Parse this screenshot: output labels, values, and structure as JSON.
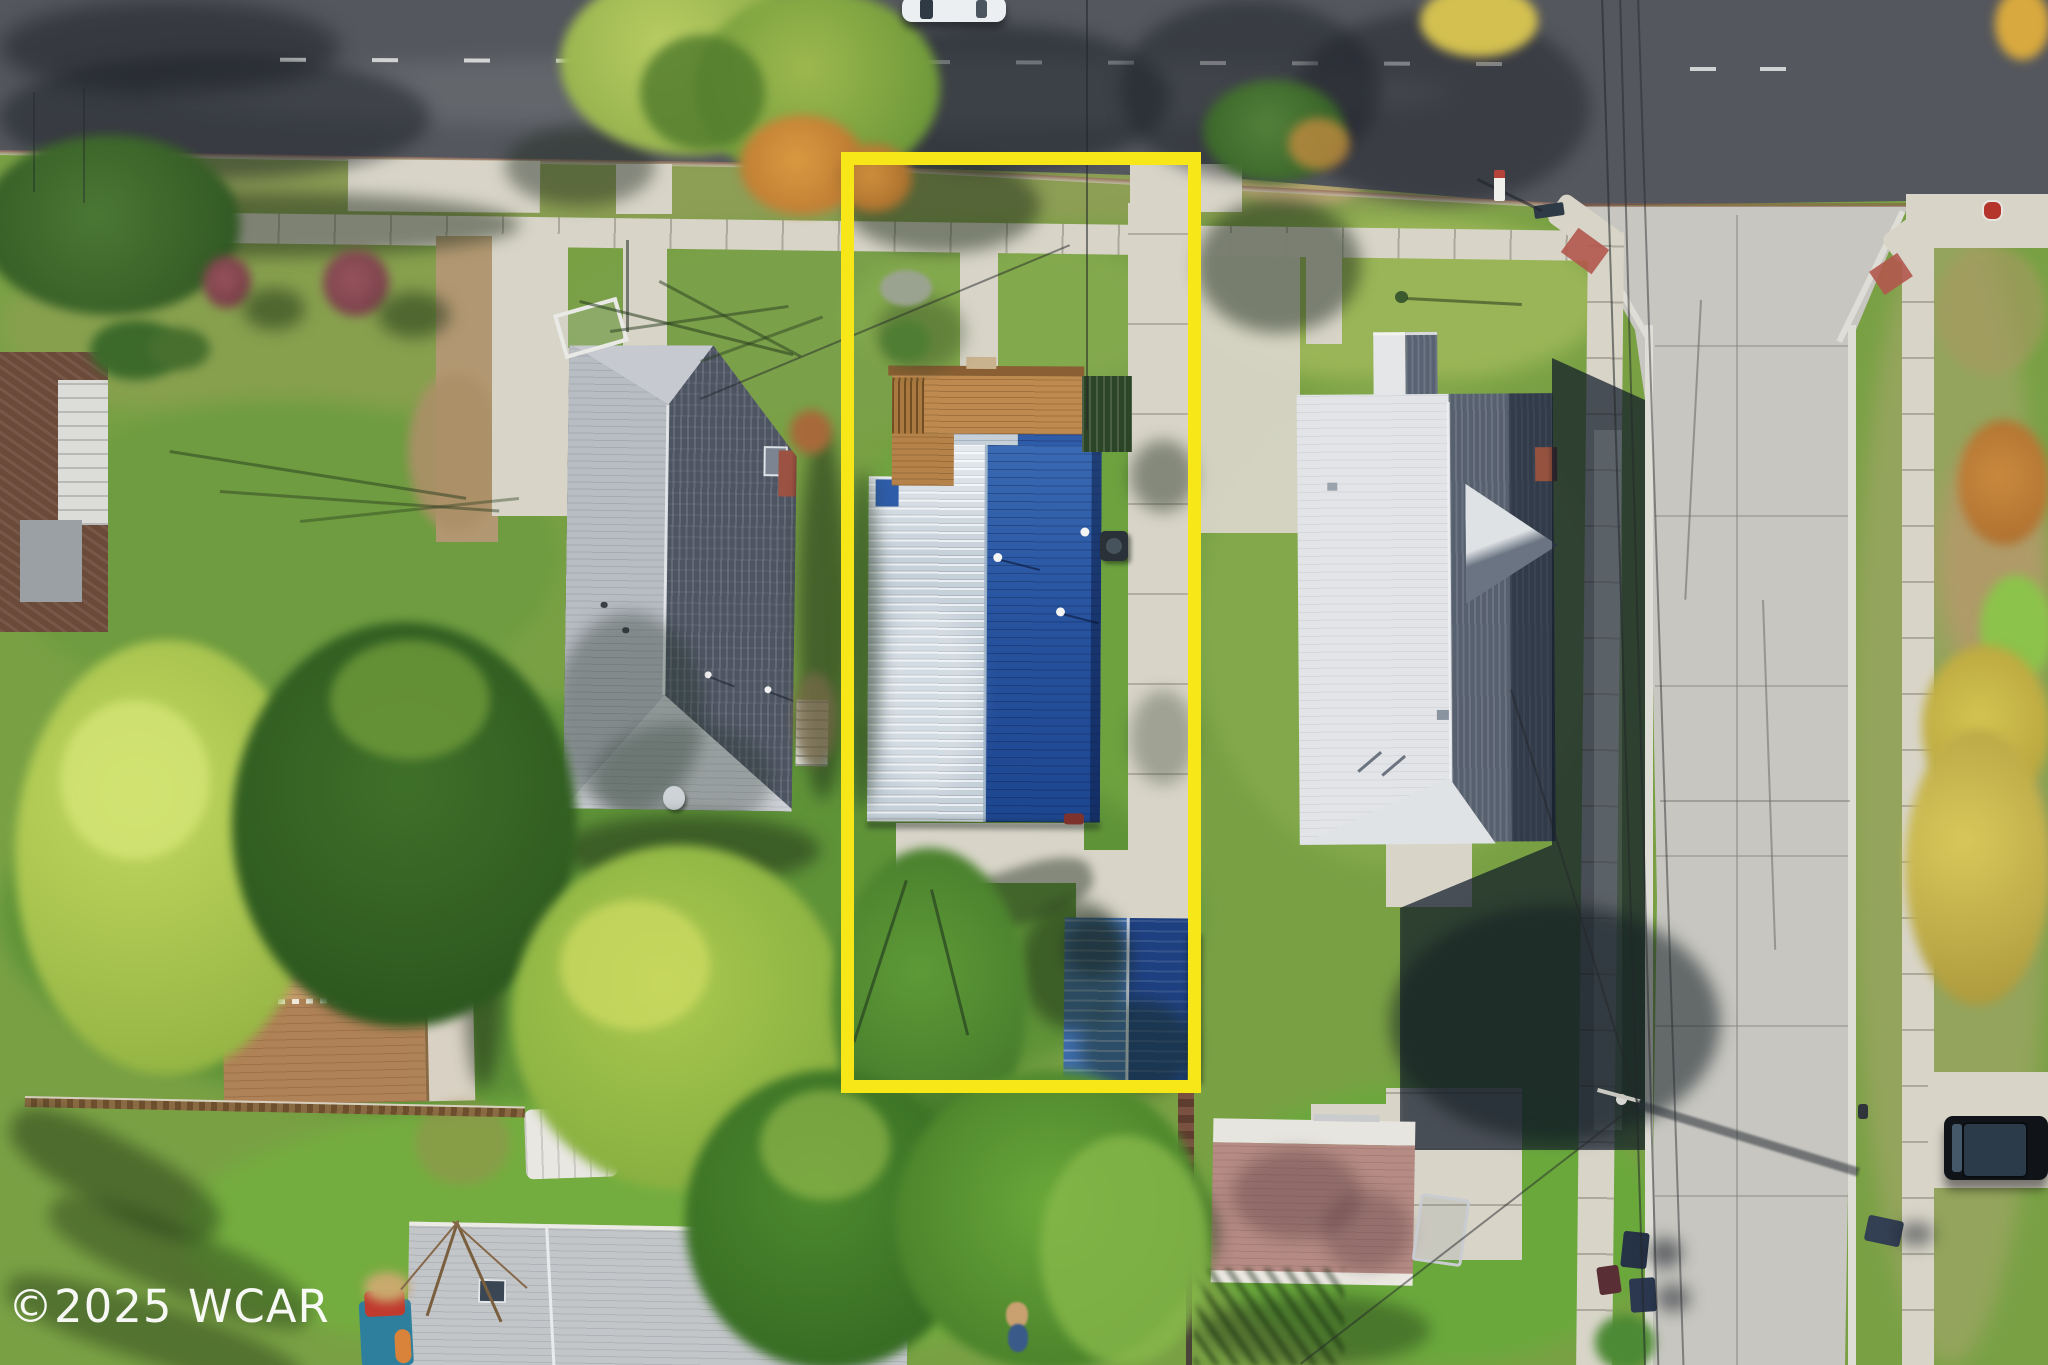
{
  "scene": {
    "type": "aerial-drone-photograph",
    "subject": "overhead view of a residential lot outlined with a yellow property boundary",
    "watermark": {
      "text": "©2025 WCAR"
    },
    "objects": [
      {
        "name": "property-boundary",
        "desc": "yellow rectangle outlining the subject lot"
      },
      {
        "name": "subject-house",
        "desc": "house with silver and blue standing-seam metal roof inside boundary"
      },
      {
        "name": "wood-deck",
        "desc": "wooden deck with pergola at north side of subject house"
      },
      {
        "name": "blue-storage-shed",
        "desc": "blue gabled shed at rear of subject lot"
      },
      {
        "name": "concrete-driveway",
        "desc": "long driveway on east side of subject lot"
      },
      {
        "name": "left-neighbor-house",
        "desc": "gray shingle hip-roof house west of subject"
      },
      {
        "name": "right-neighbor-house",
        "desc": "white/gray shingle hip-roof house east of subject"
      },
      {
        "name": "brown-shed",
        "desc": "tan gabled shed in southwest backyard"
      },
      {
        "name": "pink-roof-outbuilding",
        "desc": "rose shingle garage south of right neighbor"
      },
      {
        "name": "gray-roof-house-bottom",
        "desc": "gray shingle roof house at bottom edge"
      },
      {
        "name": "asphalt-street",
        "desc": "dark asphalt street across top"
      },
      {
        "name": "concrete-street",
        "desc": "light concrete street running down right side"
      },
      {
        "name": "t-intersection",
        "desc": "intersection with curb ramps and red tactile pads"
      },
      {
        "name": "sidewalks",
        "desc": "public sidewalks along both streets"
      },
      {
        "name": "white-car",
        "desc": "white car parked at top edge of image"
      },
      {
        "name": "black-suv",
        "desc": "black SUV parked on driveway at right edge"
      },
      {
        "name": "trash-bins",
        "desc": "navy trash bins at curbs of right street"
      },
      {
        "name": "utility-pole",
        "desc": "utility pole with shadow across concrete street"
      },
      {
        "name": "power-lines",
        "desc": "thin overhead wires crossing lots and street"
      },
      {
        "name": "autumn-trees",
        "desc": "green, yellow and orange tree canopies"
      },
      {
        "name": "child-playset",
        "desc": "teal and red playhouse at bottom left"
      }
    ]
  },
  "colors": {
    "boundary": "#f7e618",
    "blue": "#2e5da9",
    "blue-dark": "#1d4690",
    "silver": "#c6d0d9",
    "grayroof-d": "#4d5462",
    "grayroof-l": "#b8bcc3",
    "whiteroof-l": "#e2e4e7",
    "whiteroof-d": "#57606e",
    "asphalt": "#54575d",
    "concrete": "#c7c6c0",
    "walk": "#d8d5c8",
    "grassbase": "#79a144",
    "deck": "#bf8a50",
    "shedbrown": "#c59a6b",
    "shedpink": "#b58b84",
    "shedblue-l": "#3e6cab",
    "shedblue-d": "#1e4080",
    "wm": "#ffffff"
  }
}
